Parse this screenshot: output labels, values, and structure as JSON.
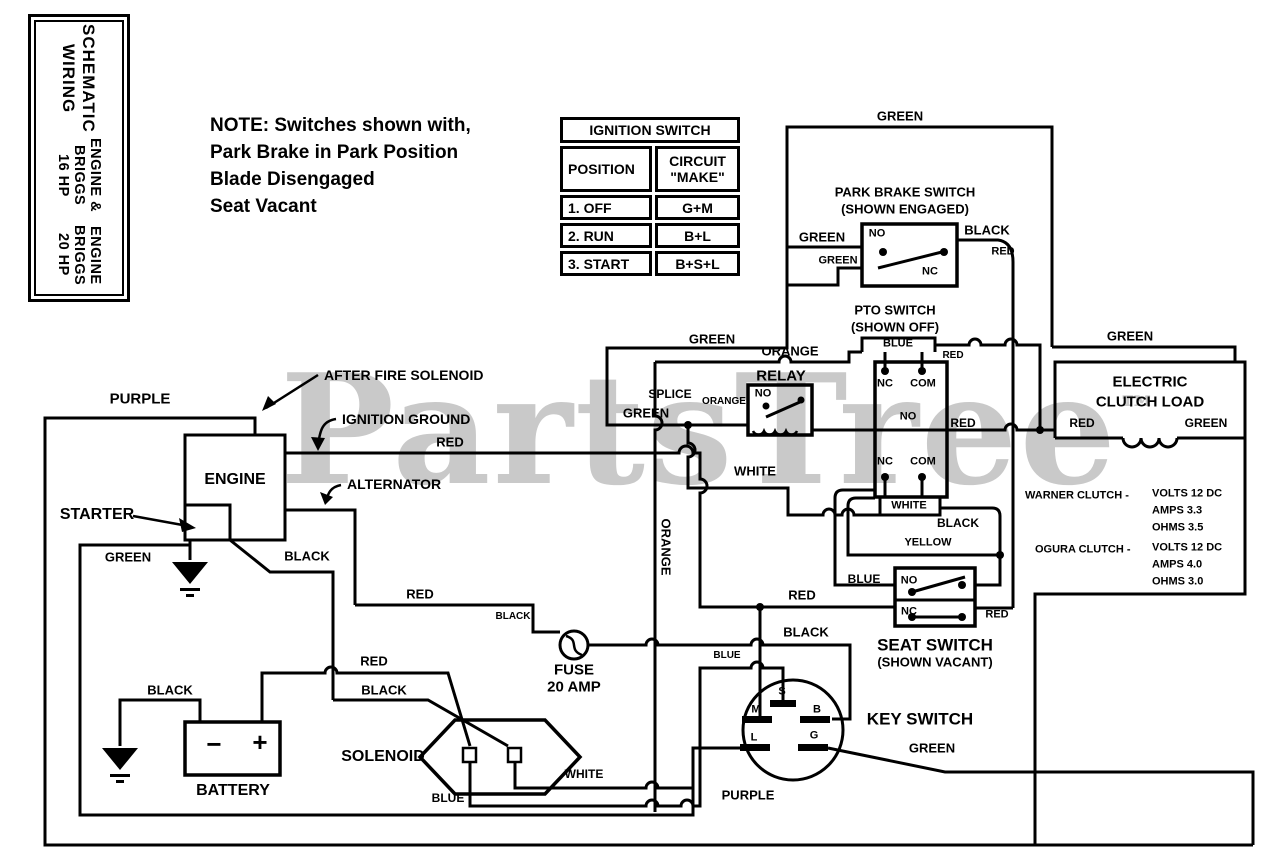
{
  "watermark": {
    "text": "PartsTree",
    "tm": "™",
    "color": "#c9c9c9"
  },
  "title_box": {
    "line1": "WIRING SCHEMATIC",
    "line2": "16 HP BRIGGS ENGINE &",
    "line3": "20 HP BRIGGS ENGINE"
  },
  "note": {
    "l1": "NOTE: Switches shown with,",
    "l2": "Park Brake in Park Position",
    "l3": "Blade Disengaged",
    "l4": "Seat Vacant"
  },
  "ignition_table": {
    "title": "IGNITION SWITCH",
    "col1": "POSITION",
    "col2": "CIRCUIT \"MAKE\"",
    "rows": [
      {
        "position": "1. OFF",
        "circuit": "G+M"
      },
      {
        "position": "2. RUN",
        "circuit": "B+L"
      },
      {
        "position": "3. START",
        "circuit": "B+S+L"
      }
    ]
  },
  "component_labels": [
    {
      "t": "ENGINE",
      "x": 235,
      "y": 480
    },
    {
      "t": "STARTER",
      "x": 97,
      "y": 515
    },
    {
      "t": "BATTERY",
      "x": 233,
      "y": 791
    },
    {
      "t": "SOLENOID",
      "x": 383,
      "y": 757
    },
    {
      "t": "FUSE",
      "x": 574,
      "y": 670,
      "fs": 15
    },
    {
      "t": "20 AMP",
      "x": 574,
      "y": 687,
      "fs": 15
    },
    {
      "t": "RELAY",
      "x": 781,
      "y": 376,
      "fs": 15
    },
    {
      "t": "SPLICE",
      "x": 670,
      "y": 394,
      "fs": 12
    },
    {
      "t": "KEY SWITCH",
      "x": 920,
      "y": 719,
      "fs": 17
    },
    {
      "t": "SEAT SWITCH",
      "x": 935,
      "y": 645,
      "fs": 17
    },
    {
      "t": "(SHOWN VACANT)",
      "x": 935,
      "y": 662,
      "fs": 13
    },
    {
      "t": "PARK BRAKE SWITCH",
      "x": 905,
      "y": 192,
      "fs": 13
    },
    {
      "t": "(SHOWN ENGAGED)",
      "x": 905,
      "y": 209,
      "fs": 13
    },
    {
      "t": "PTO SWITCH",
      "x": 895,
      "y": 310,
      "fs": 13
    },
    {
      "t": "(SHOWN OFF)",
      "x": 895,
      "y": 327,
      "fs": 13
    },
    {
      "t": "ELECTRIC",
      "x": 1150,
      "y": 382,
      "fs": 15
    },
    {
      "t": "CLUTCH LOAD",
      "x": 1150,
      "y": 402,
      "fs": 15
    },
    {
      "t": "AFTER FIRE SOLENOID",
      "x": 324,
      "y": 375,
      "fs": 14,
      "a": "left"
    },
    {
      "t": "IGNITION GROUND",
      "x": 342,
      "y": 419,
      "fs": 14,
      "a": "left"
    },
    {
      "t": "ALTERNATOR",
      "x": 347,
      "y": 484,
      "fs": 14,
      "a": "left"
    },
    {
      "t": "WARNER CLUTCH -",
      "x": 1025,
      "y": 496,
      "fs": 11,
      "a": "left",
      "n": "warner-clutch-label"
    },
    {
      "t": "VOLTS 12 DC",
      "x": 1152,
      "y": 494,
      "fs": 11,
      "a": "left",
      "n": "warner-volts"
    },
    {
      "t": "AMPS 3.3",
      "x": 1152,
      "y": 511,
      "fs": 11,
      "a": "left",
      "n": "warner-amps"
    },
    {
      "t": "OHMS 3.5",
      "x": 1152,
      "y": 528,
      "fs": 11,
      "a": "left",
      "n": "warner-ohms"
    },
    {
      "t": "OGURA CLUTCH -",
      "x": 1035,
      "y": 550,
      "fs": 11,
      "a": "left",
      "n": "ogura-clutch-label"
    },
    {
      "t": "VOLTS 12 DC",
      "x": 1152,
      "y": 548,
      "fs": 11,
      "a": "left",
      "n": "ogura-volts"
    },
    {
      "t": "AMPS 4.0",
      "x": 1152,
      "y": 565,
      "fs": 11,
      "a": "left",
      "n": "ogura-amps"
    },
    {
      "t": "OHMS 3.0",
      "x": 1152,
      "y": 582,
      "fs": 11,
      "a": "left",
      "n": "ogura-ohms"
    }
  ],
  "wire_labels": [
    {
      "t": "GREEN",
      "x": 900,
      "y": 116
    },
    {
      "t": "GREEN",
      "x": 822,
      "y": 237
    },
    {
      "t": "BLACK",
      "x": 987,
      "y": 230
    },
    {
      "t": "GREEN",
      "x": 838,
      "y": 261,
      "fs": 11
    },
    {
      "t": "RED",
      "x": 1003,
      "y": 252,
      "fs": 11
    },
    {
      "t": "GREEN",
      "x": 712,
      "y": 339
    },
    {
      "t": "ORANGE",
      "x": 790,
      "y": 351
    },
    {
      "t": "BLUE",
      "x": 898,
      "y": 344,
      "fs": 11
    },
    {
      "t": "RED",
      "x": 953,
      "y": 356,
      "fs": 10
    },
    {
      "t": "GREEN",
      "x": 1130,
      "y": 336
    },
    {
      "t": "GREEN",
      "x": 646,
      "y": 413
    },
    {
      "t": "ORANGE",
      "x": 724,
      "y": 402,
      "fs": 10
    },
    {
      "t": "RED",
      "x": 450,
      "y": 442
    },
    {
      "t": "WHITE",
      "x": 755,
      "y": 471
    },
    {
      "t": "ORANGE",
      "x": 666,
      "y": 547,
      "r": 90
    },
    {
      "t": "RED",
      "x": 963,
      "y": 423,
      "fs": 12
    },
    {
      "t": "WHITE",
      "x": 909,
      "y": 506,
      "fs": 11
    },
    {
      "t": "BLACK",
      "x": 958,
      "y": 523,
      "fs": 12
    },
    {
      "t": "YELLOW",
      "x": 928,
      "y": 543,
      "fs": 11
    },
    {
      "t": "BLUE",
      "x": 864,
      "y": 579,
      "fs": 12
    },
    {
      "t": "RED",
      "x": 997,
      "y": 615,
      "fs": 11
    },
    {
      "t": "BLACK",
      "x": 806,
      "y": 632
    },
    {
      "t": "BLUE",
      "x": 727,
      "y": 656,
      "fs": 10
    },
    {
      "t": "GREEN",
      "x": 932,
      "y": 748
    },
    {
      "t": "PURPLE",
      "x": 748,
      "y": 795
    },
    {
      "t": "PURPLE",
      "x": 140,
      "y": 399,
      "fs": 15
    },
    {
      "t": "GREEN",
      "x": 128,
      "y": 557
    },
    {
      "t": "BLACK",
      "x": 307,
      "y": 556
    },
    {
      "t": "RED",
      "x": 374,
      "y": 661
    },
    {
      "t": "BLACK",
      "x": 384,
      "y": 690
    },
    {
      "t": "BLACK",
      "x": 170,
      "y": 690
    },
    {
      "t": "RED",
      "x": 420,
      "y": 594
    },
    {
      "t": "BLACK",
      "x": 513,
      "y": 617,
      "fs": 10
    },
    {
      "t": "WHITE",
      "x": 584,
      "y": 774,
      "fs": 12
    },
    {
      "t": "BLUE",
      "x": 448,
      "y": 798,
      "fs": 12
    },
    {
      "t": "RED",
      "x": 802,
      "y": 595
    },
    {
      "t": "RED",
      "x": 1082,
      "y": 423,
      "fs": 12
    },
    {
      "t": "GREEN",
      "x": 1206,
      "y": 423,
      "fs": 12
    }
  ],
  "terminal_labels": [
    {
      "t": "NO",
      "x": 877,
      "y": 234,
      "n": "park-brake-no"
    },
    {
      "t": "NC",
      "x": 930,
      "y": 272,
      "n": "park-brake-nc"
    },
    {
      "t": "NO",
      "x": 763,
      "y": 394,
      "n": "relay-no"
    },
    {
      "t": "NC",
      "x": 885,
      "y": 384,
      "n": "pto-top-nc"
    },
    {
      "t": "COM",
      "x": 923,
      "y": 384,
      "n": "pto-top-com"
    },
    {
      "t": "NO",
      "x": 908,
      "y": 417,
      "n": "pto-no"
    },
    {
      "t": "NC",
      "x": 885,
      "y": 462,
      "n": "pto-bottom-nc"
    },
    {
      "t": "COM",
      "x": 923,
      "y": 462,
      "n": "pto-bottom-com"
    },
    {
      "t": "NO",
      "x": 909,
      "y": 581,
      "n": "seat-no"
    },
    {
      "t": "NC",
      "x": 909,
      "y": 612,
      "n": "seat-nc"
    },
    {
      "t": "S",
      "x": 782,
      "y": 692,
      "n": "key-terminal-s"
    },
    {
      "t": "M",
      "x": 756,
      "y": 710,
      "n": "key-terminal-m"
    },
    {
      "t": "B",
      "x": 817,
      "y": 710,
      "n": "key-terminal-b"
    },
    {
      "t": "L",
      "x": 754,
      "y": 738,
      "n": "key-terminal-l"
    },
    {
      "t": "G",
      "x": 814,
      "y": 736,
      "n": "key-terminal-g"
    },
    {
      "t": "−",
      "x": 214,
      "y": 744,
      "fs": 26,
      "n": "battery-minus"
    },
    {
      "t": "+",
      "x": 260,
      "y": 742,
      "fs": 26,
      "n": "battery-plus"
    }
  ]
}
